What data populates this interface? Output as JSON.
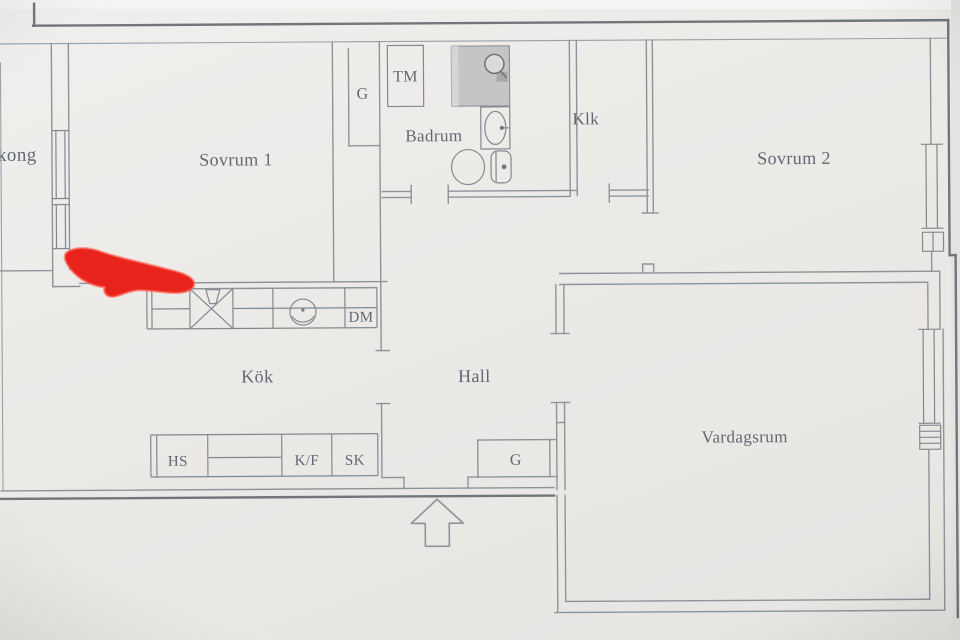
{
  "floor_plan": {
    "rooms": {
      "balkong_partial": "kong",
      "sovrum1": "Sovrum 1",
      "badrum": "Badrum",
      "klk": "Klk",
      "sovrum2": "Sovrum 2",
      "kok": "Kök",
      "hall": "Hall",
      "vardagsrum": "Vardagsrum"
    },
    "fixtures": {
      "garderob_top": "G",
      "tvattmaskin": "TM",
      "diskmaskin": "DM",
      "hogskap": "HS",
      "kyl_frys": "K/F",
      "stadskap": "SK",
      "garderob_hall": "G"
    },
    "colors": {
      "paper": "#edecea",
      "wall": "#8e939b",
      "wall_dark": "#72757b",
      "label_text": "#4e5563",
      "marker_red": "#e8231b",
      "shower_fill": "#c5c4c6"
    }
  }
}
